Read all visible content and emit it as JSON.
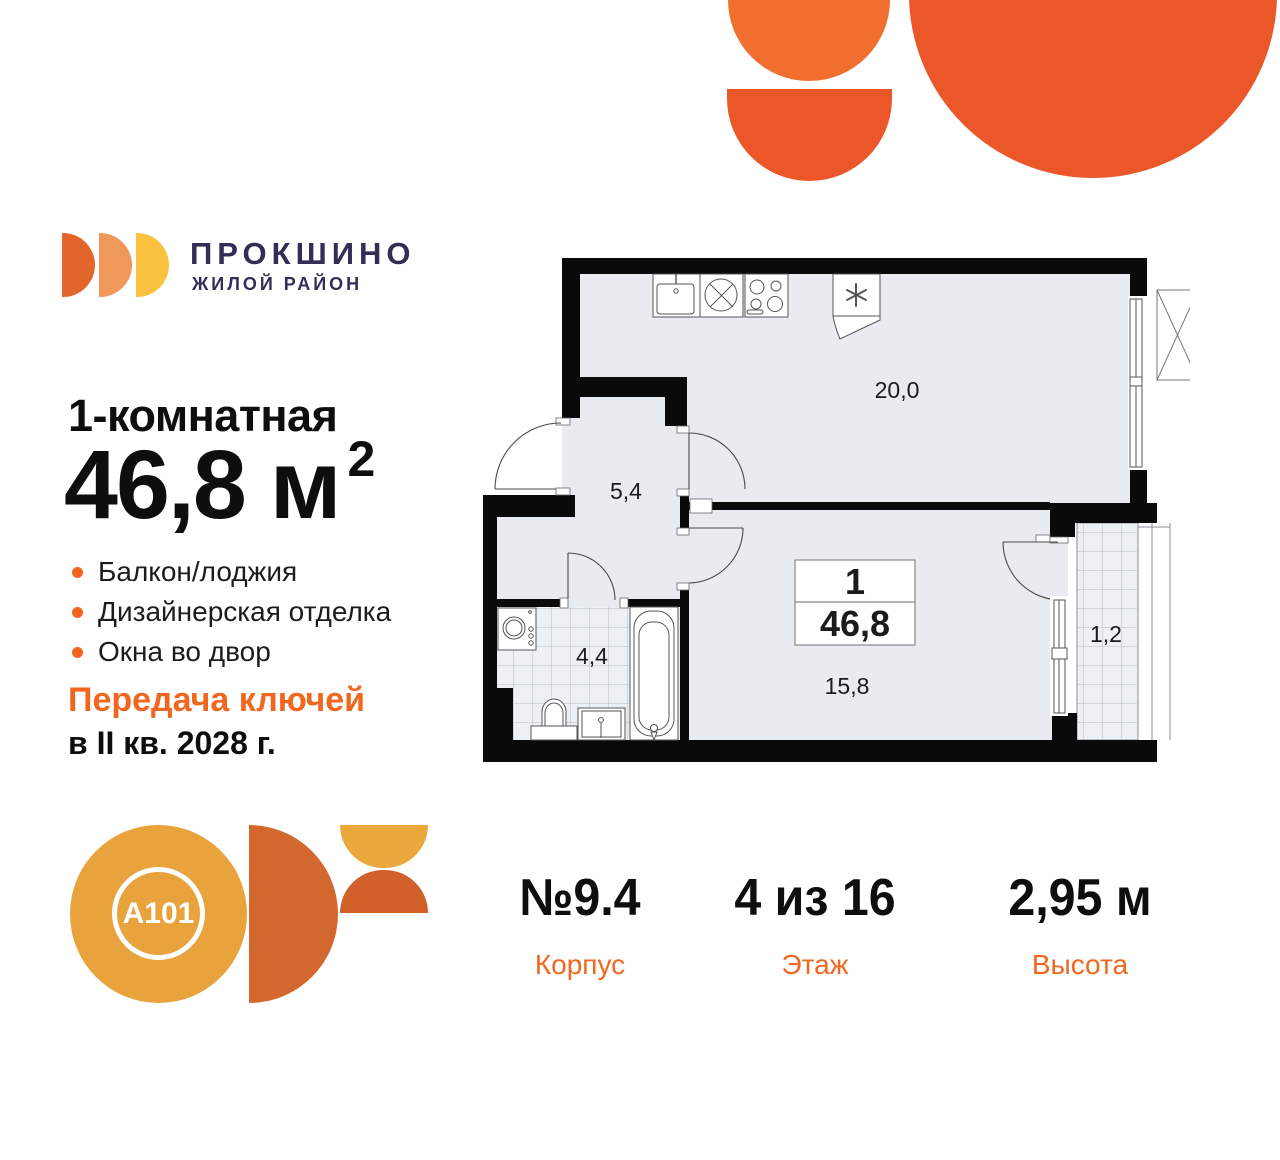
{
  "brand": {
    "name": "ПРОКШИНО",
    "tagline": "ЖИЛОЙ РАЙОН",
    "navy": "#312E58",
    "arc_colors": [
      "#E2662C",
      "#F0975A",
      "#F9C23E"
    ]
  },
  "offer": {
    "rooms_title": "1-комнатная",
    "area_value": "46,8 м",
    "area_sup": "2",
    "features": [
      "Балкон/лоджия",
      "Дизайнерская отделка",
      "Окна во двор"
    ],
    "handover_line1": "Передача ключей",
    "handover_line2": "в II кв. 2028 г."
  },
  "developer": {
    "logo_text": "A101"
  },
  "stats": [
    {
      "value": "№9.4",
      "label": "Корпус"
    },
    {
      "value": "4 из 16",
      "label": "Этаж"
    },
    {
      "value": "2,95 м",
      "label": "Высота"
    }
  ],
  "floorplan": {
    "unit_box": {
      "rooms": "1",
      "area": "46,8"
    },
    "room_labels": [
      {
        "text": "20,0"
      },
      {
        "text": "5,4"
      },
      {
        "text": "4,4"
      },
      {
        "text": "15,8"
      },
      {
        "text": "1,2"
      }
    ]
  },
  "colors": {
    "accent_orange": "#F2671F",
    "deco_orange": "#EB5728",
    "deco_orange_light": "#F06E2E",
    "a101_gold": "#E8A33D",
    "a101_rust": "#D2682E",
    "a101_yellow": "#EAA83C",
    "a101_red": "#D2602A",
    "wall_black": "#0A0A0A",
    "floor_fill": "#E8EBEF"
  }
}
